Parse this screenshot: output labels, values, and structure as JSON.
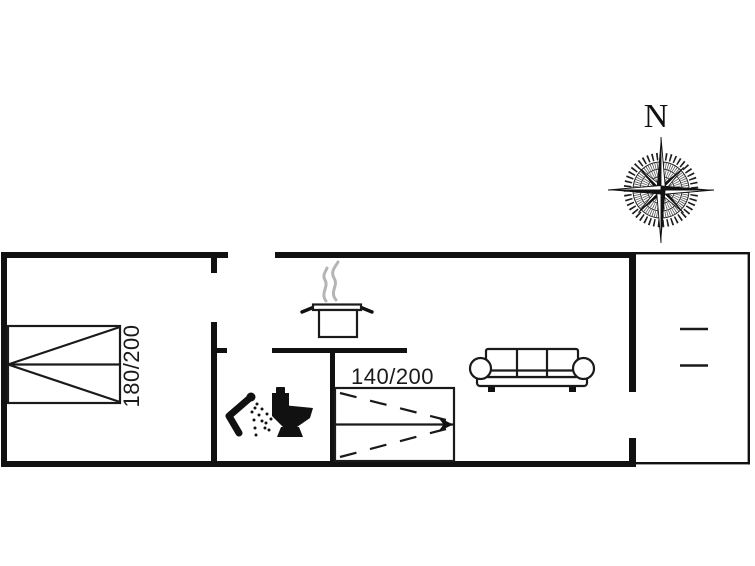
{
  "floor_plan": {
    "compass_label": "N",
    "double_bed_label": "180/200",
    "pullout_bed_label": "140/200"
  },
  "colors": {
    "background": "#ffffff",
    "wall": "#111111",
    "furniture_line": "#1a1a1a",
    "steam": "#b5b5b5"
  },
  "icons": [
    "compass-rose-icon",
    "double-bed-icon",
    "shower-icon",
    "toilet-icon",
    "cooking-pot-icon",
    "steam-icon",
    "pullout-bed-icon",
    "sofa-icon",
    "terrace-table-icon"
  ]
}
